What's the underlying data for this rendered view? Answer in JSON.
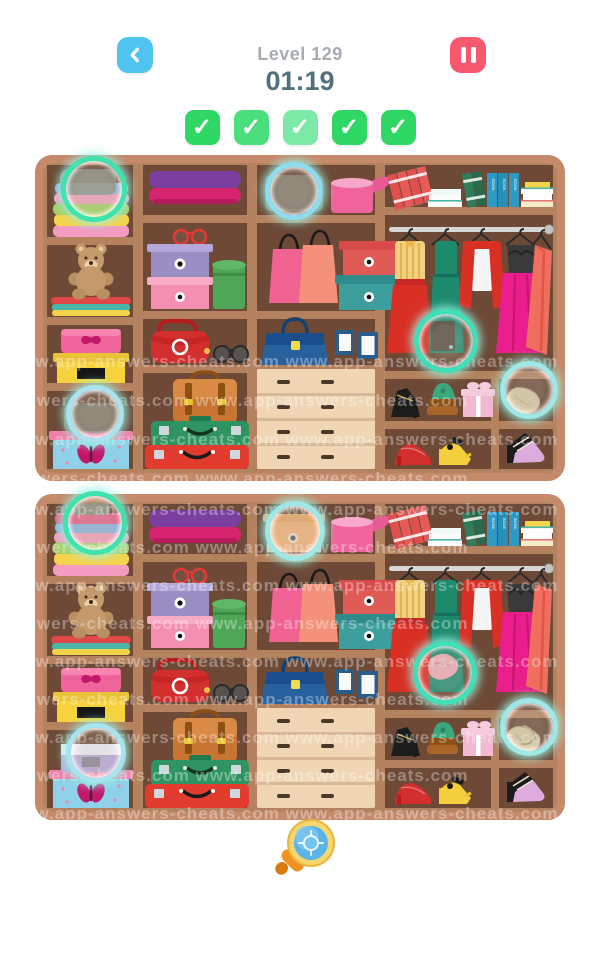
{
  "header": {
    "title": "Level 129",
    "timer": "01:19",
    "back_icon": "chevron-left-icon",
    "pause_icon": "pause-icon"
  },
  "progress": {
    "found": 5,
    "total": 5,
    "checks": [
      {
        "icon": "check",
        "color": "#2fd765"
      },
      {
        "icon": "check",
        "color": "#4ade7d"
      },
      {
        "icon": "check",
        "color": "#7ce9a6"
      },
      {
        "icon": "check",
        "color": "#2fd765"
      },
      {
        "icon": "check",
        "color": "#2fd765"
      }
    ]
  },
  "watermark": {
    "text": "www.app-answers-cheats.com"
  },
  "hint": {
    "icon": "magnifier-crosshair-icon"
  },
  "colors": {
    "accent_blue": "#4fc4f0",
    "accent_red": "#f8586f",
    "check_green": "#2fd765",
    "ring_teal": "#49e2c4",
    "wood_frame": "#c48a6a",
    "wood_mid": "#b5825f",
    "wood_dark": "#6d4936"
  },
  "scene": {
    "book_spine_label": "BOOK",
    "items": [
      "towel-stack",
      "teddy-bear",
      "hat-box-pink-butterfly",
      "gift-box-yellow",
      "gift-box-blue-butterfly",
      "folded-clothes-purple",
      "sunglasses-red",
      "box-purple-dot",
      "box-pink-dot",
      "hat-box-green",
      "handbag-red",
      "sunglasses-black",
      "satchel-brown",
      "suitcase-green",
      "suitcase-red",
      "hat-box-pink-open",
      "shopping-bag-pink",
      "shopping-bag-salmon",
      "box-red-dot",
      "box-teal-dot",
      "handbag-navy",
      "picture-frames",
      "drawer-unit",
      "books-and-binders",
      "clothes-rail",
      "blouse-with-red-skirt",
      "dress-teal",
      "red-jacket-white-top",
      "black-top-pink-skirt",
      "coat-coral",
      "heels-black",
      "sandals-green",
      "gift-box-pink-bow",
      "folded-item-beige",
      "heels-red",
      "sandals-yellow",
      "heels-black-pink"
    ]
  },
  "differences": {
    "found_markers": {
      "top_panel": [
        {
          "x": 54,
          "y": 29,
          "r": 28,
          "color": "#3fe3ae",
          "label": "towel-stack-top"
        },
        {
          "x": 254,
          "y": 31,
          "r": 24,
          "color": "#8fdcef",
          "label": "missing-orange-box"
        },
        {
          "x": 406,
          "y": 181,
          "r": 27,
          "color": "#3fe0b8",
          "label": "missing-glove"
        },
        {
          "x": 55,
          "y": 254,
          "r": 24,
          "color": "#a8e4f0",
          "label": "missing-purple-box"
        },
        {
          "x": 489,
          "y": 230,
          "r": 24,
          "color": "#9fe8e8",
          "label": "beige-item"
        }
      ],
      "bottom_panel": [
        {
          "x": 55,
          "y": 24,
          "r": 27,
          "color": "#3fe3ae",
          "label": "towel-stack-top"
        },
        {
          "x": 255,
          "y": 32,
          "r": 25,
          "color": "#9fe8e8",
          "label": "orange-box"
        },
        {
          "x": 405,
          "y": 174,
          "r": 27,
          "color": "#3fe0b8",
          "label": "pink-glove"
        },
        {
          "x": 56,
          "y": 254,
          "r": 25,
          "color": "#a8e4f0",
          "label": "purple-box"
        },
        {
          "x": 489,
          "y": 228,
          "r": 24,
          "color": "#9fe8e8",
          "label": "beige-item"
        }
      ]
    }
  }
}
